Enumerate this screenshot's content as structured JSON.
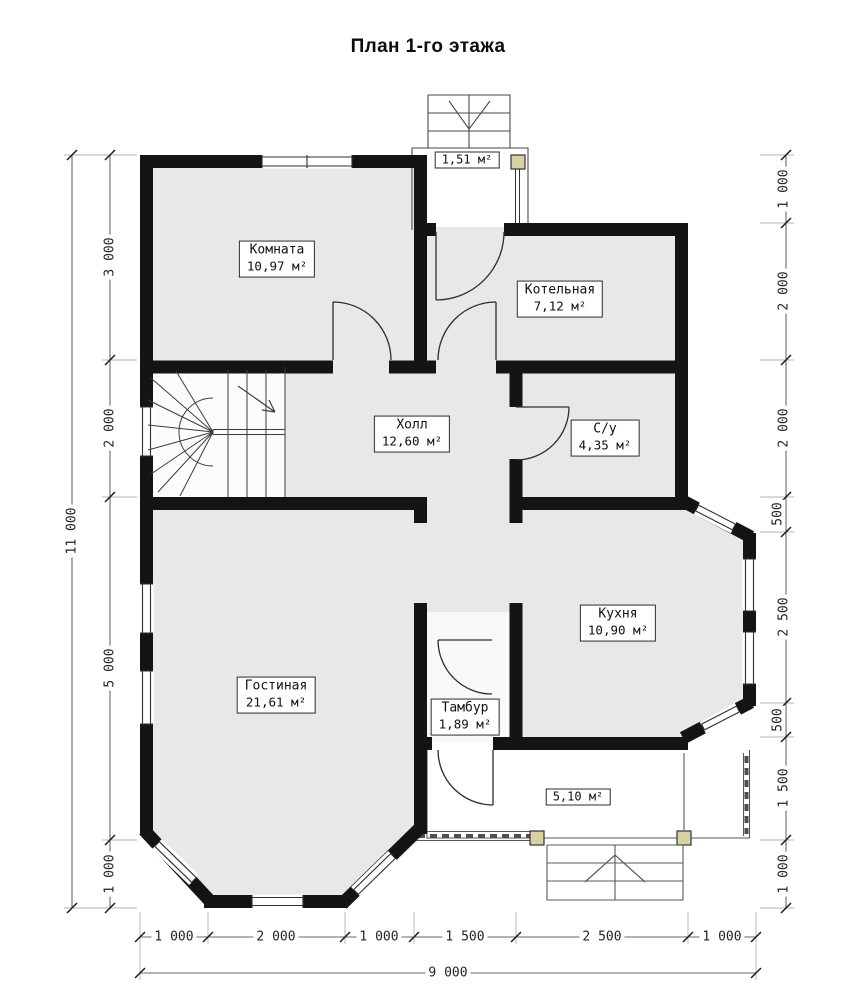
{
  "title": "План 1-го этажа",
  "rooms": {
    "komnata": {
      "name": "Комната",
      "area": "10,97 м²"
    },
    "kotelnaya": {
      "name": "Котельная",
      "area": "7,12 м²"
    },
    "holl": {
      "name": "Холл",
      "area": "12,60 м²"
    },
    "su": {
      "name": "С/у",
      "area": "4,35 м²"
    },
    "kuhnya": {
      "name": "Кухня",
      "area": "10,90 м²"
    },
    "gostinaya": {
      "name": "Гостиная",
      "area": "21,61 м²"
    },
    "tambur": {
      "name": "Тамбур",
      "area": "1,89 м²"
    }
  },
  "outdoor": {
    "porch_area": "1,51 м²",
    "terrace_area": "5,10 м²"
  },
  "dimensions": {
    "left_total": "11 000",
    "left": [
      "3 000",
      "2 000",
      "5 000",
      "1 000"
    ],
    "right": [
      "1 000",
      "2 000",
      "2 000",
      "500",
      "2 500",
      "500",
      "1 500",
      "1 000"
    ],
    "bottom": [
      "1 000",
      "2 000",
      "1 000",
      "1 500",
      "2 500",
      "1 000"
    ],
    "bottom_total": "9 000"
  },
  "colors": {
    "wall": "#141414",
    "room_fill": "#e8e8e7",
    "post_fill": "#d8d1a6"
  }
}
